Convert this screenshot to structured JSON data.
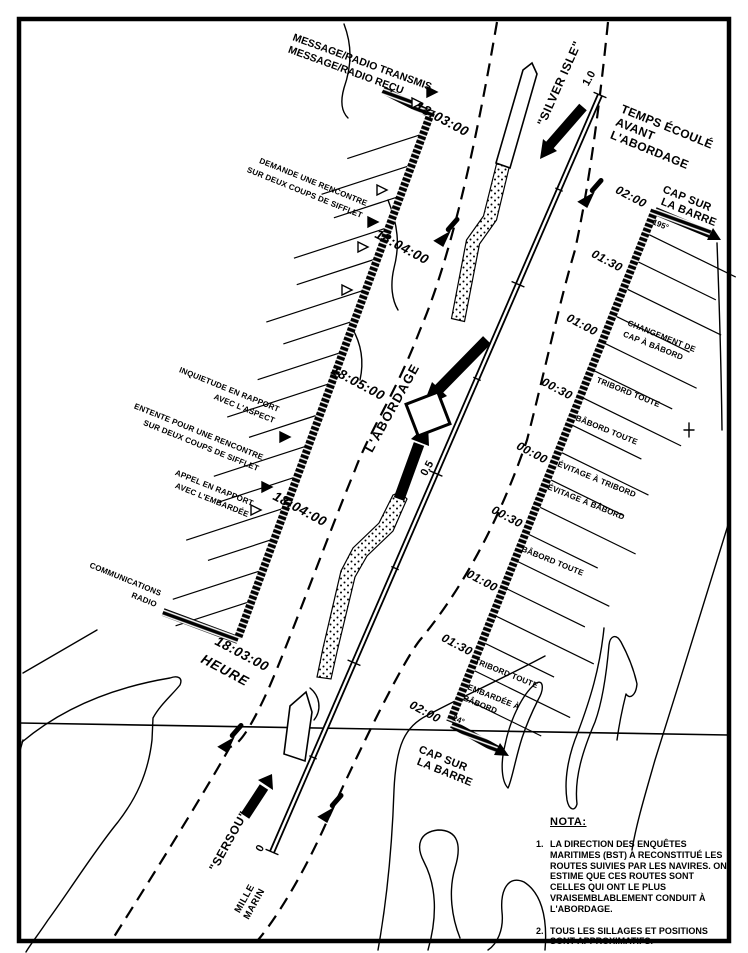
{
  "colors": {
    "ink": "#000000",
    "paper": "#ffffff"
  },
  "legend": {
    "lines": [
      "MESSAGE/RADIO TRANSMIS",
      "MESSAGE/RADIO REÇU"
    ]
  },
  "ships": {
    "silver_isle": "\"SILVER ISLE\"",
    "sersou": "\"SERSOU\""
  },
  "collision": {
    "label": "L'ABORDAGE"
  },
  "scale": {
    "zero": "0",
    "half": "0.5",
    "one": "1.0",
    "unit_lines": [
      "MILLE",
      "MARIN"
    ]
  },
  "left_timeline": {
    "axis_label": "HEURE",
    "times": [
      "18:03:00",
      "18:04:00",
      "18:05:00",
      "18:04:00",
      "18:03:00"
    ],
    "annotations": [
      {
        "lines": [
          "DEMANDE UNE RENCONTRE",
          "SUR DEUX COUPS DE SIFFLET"
        ]
      },
      {
        "lines": [
          "INQUIETUDE EN RAPPORT",
          "AVEC L'ASPECT"
        ]
      },
      {
        "lines": [
          "ENTENTE POUR UNE RENCONTRE",
          "SUR DEUX COUPS DE SIFFLET"
        ]
      },
      {
        "lines": [
          "APPEL EN RAPPORT",
          "AVEC L'EMBARDÉE"
        ]
      },
      {
        "lines": [
          "COMMUNICATIONS",
          "RADIO"
        ]
      }
    ]
  },
  "right_timeline": {
    "header_lines": [
      "TEMPS ÉCOULÉ",
      "AVANT",
      "L'ABORDAGE"
    ],
    "times": [
      "02:00",
      "01:30",
      "01:00",
      "00:30",
      "00:00",
      "00:30",
      "01:00",
      "01:30",
      "02:00"
    ],
    "top_heading": {
      "lines": [
        "CAP SUR",
        "LA BARRE"
      ],
      "course": "195°"
    },
    "bottom_heading": {
      "lines": [
        "CAP SUR",
        "LA BARRE"
      ],
      "course": "24°"
    },
    "maneuvers": [
      {
        "lines": [
          "CHANGEMENT DE",
          "CAP À BÂBORD"
        ]
      },
      {
        "lines": [
          "TRIBORD TOUTE"
        ]
      },
      {
        "lines": [
          "BÂBORD TOUTE"
        ]
      },
      {
        "lines": [
          "ÉVITAGE À TRIBORD"
        ]
      },
      {
        "lines": [
          "ÉVITAGE À BÂBORD"
        ]
      },
      {
        "lines": [
          "BÂBORD TOUTE"
        ]
      },
      {
        "lines": [
          "TRIBORD TOUTE"
        ]
      },
      {
        "lines": [
          "EMBARDÉE À",
          "BÂBORD"
        ]
      }
    ]
  },
  "nota": {
    "title": "NOTA:",
    "items": [
      {
        "num": "1.",
        "text": "LA DIRECTION DES ENQUÊTES MARITIMES (BST) A RECONSTITUÉ LES ROUTES SUIVIES PAR LES NAVIRES.  ON ESTIME QUE CES ROUTES SONT CELLES QUI ONT LE PLUS VRAISEMBLABLEMENT CONDUIT À L'ABORDAGE."
      },
      {
        "num": "2.",
        "text": "TOUS LES SILLAGES ET POSITIONS SONT APPROXIMATIFS."
      }
    ]
  }
}
